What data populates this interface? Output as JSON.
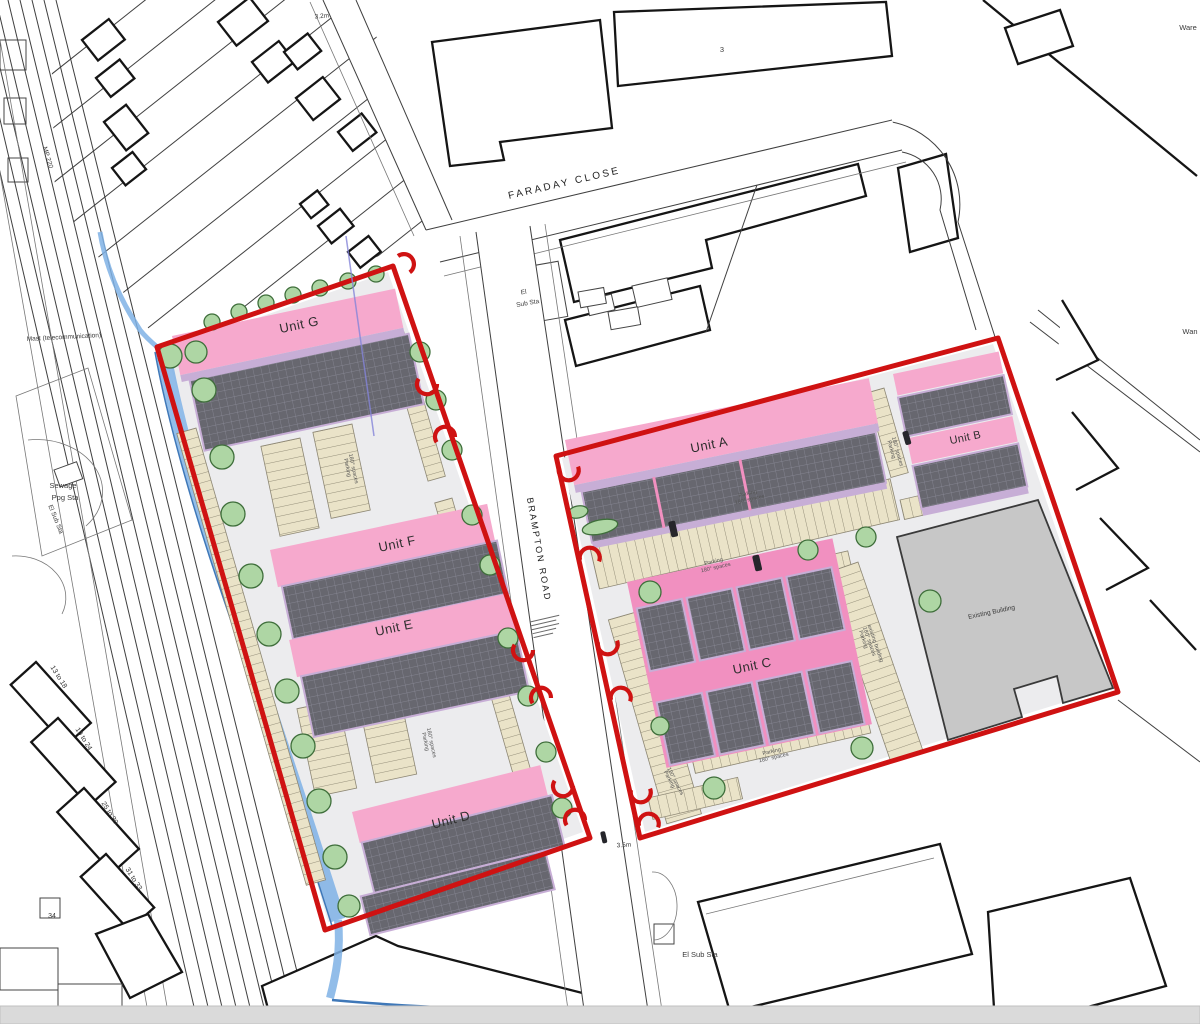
{
  "colors": {
    "boundary_red": "#cf1212",
    "building_pink": "#f6a9cd",
    "building_pink_deep": "#f190c0",
    "lavender": "#c7aed6",
    "roof_base": "#67676f",
    "roof_line": "#8e8e9b",
    "parking_beige": "#eae3c8",
    "parking_line": "#958f7a",
    "asphalt": "#ececee",
    "tree_green": "#aed6a4",
    "tree_outline": "#3e6e3a",
    "water_blue": "#7fb2e5",
    "existing_gray": "#c7c7c7",
    "bottom_bar": "#dadada"
  },
  "site": {
    "units": {
      "a": "Unit A",
      "b": "Unit B",
      "c": "Unit C",
      "d": "Unit D",
      "e": "Unit E",
      "f": "Unit F",
      "g": "Unit G"
    }
  },
  "roads": {
    "faraday_close": "FARADAY CLOSE",
    "brampton_road": "BRAMPTON ROAD"
  },
  "labels": {
    "el_substation_line1": "El",
    "el_substation_line2": "Sub Sta",
    "el_substation_bottom": "El Sub Sta",
    "el_substation_small": "El Sub Sta",
    "sewage_line1": "Sewage",
    "sewage_line2": "Ppg Sta",
    "mast": "Mast (telecommunication)",
    "milepost": "MP 220",
    "existing_building": "Existing Building",
    "dim_3_2m": "3.2m",
    "dim_3_5m": "3.5m",
    "building_3": "3",
    "flats_13_18": "13 to 18",
    "flats_19_24": "19 to 24",
    "flats_25_30": "25 to 30",
    "flats_31_33": "31 to 33",
    "flats_34": "34",
    "warehouse_cut": "Ware",
    "cut_label": "Wan"
  },
  "parking_notes": {
    "line1": "Parking",
    "line2": "180° spaces",
    "existing_line1": "Parking",
    "existing_line2": "180° spaces",
    "existing_line3": "existing building"
  }
}
